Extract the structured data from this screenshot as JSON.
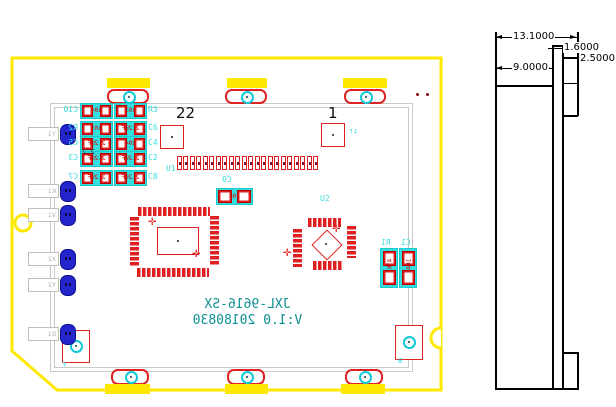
{
  "palette": {
    "board_outline_yellow": "#ffe800",
    "pad_red": "#e02020",
    "silk_cyan": "#35dede",
    "text_teal": "#0e9094",
    "hole_blue": "#2525cc",
    "frame_gray": "#c9c9c9",
    "dimension_black": "#000000"
  },
  "pcb": {
    "pin_numbers": {
      "left": "22",
      "right": "1"
    },
    "silkscreen": {
      "line1": "JXL-9616-SX",
      "line2": "V:1.0  20180830",
      "mirrored": true
    },
    "components": {
      "u1": {
        "ref": "U1",
        "pins": 22
      },
      "u2": {
        "ref": "U2"
      },
      "c9": {
        "ref": "C9",
        "value": "104"
      },
      "r1": {
        "ref": "R1",
        "value": "47K"
      },
      "c1": {
        "ref": "C1",
        "value": "104"
      }
    },
    "cap_grid": {
      "left_refs": [
        "C10",
        "R2",
        "C5",
        "C3",
        "C7"
      ],
      "right_refs": [
        "R3",
        "C6",
        "C4",
        "C2",
        "C8"
      ],
      "left_values": [
        "104",
        "103",
        "2.2UF",
        "2.2UF",
        "2.2UF"
      ],
      "right_values": [
        "103",
        "2.2UF",
        "104",
        "2.2UF",
        "2.2UF"
      ],
      "overlay_note": "2.2"
    },
    "edge_labels": [
      "Y1",
      "K1",
      "V1",
      "X2",
      "Y2",
      "D1"
    ],
    "marks": {
      "near_fiducial": "ır",
      "bottom_left": "F",
      "bottom_right": "B"
    }
  },
  "dimension_view": {
    "overall_width": "13.1000",
    "body_width": "9.0000",
    "pcb_thickness": "1.6000",
    "connector_depth": "2.5000"
  }
}
